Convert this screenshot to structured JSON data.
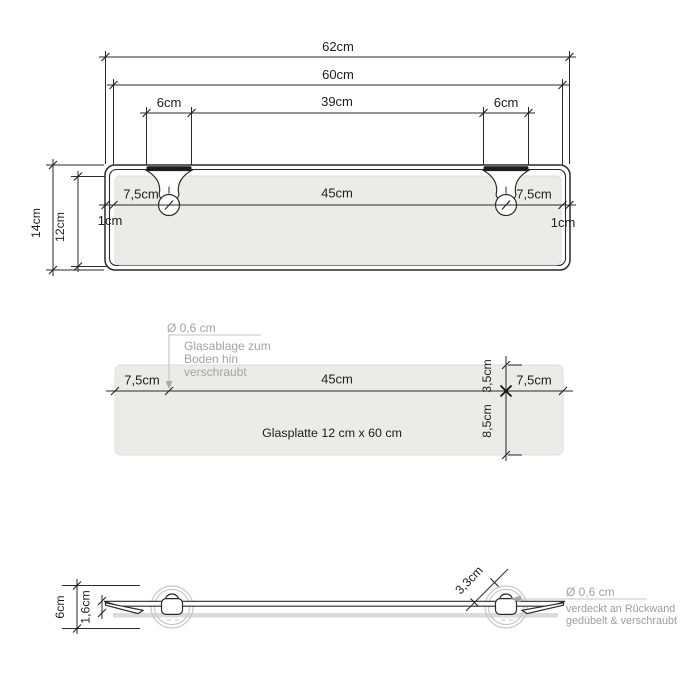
{
  "colors": {
    "line": "#2a2a2a",
    "gray_annotation": "#a3a3a3",
    "glass_fill": "#ebebe8",
    "wall_rail": "#dbdbd8",
    "mount_ring": "#c7c7c5",
    "bracket_bar": "#1c1c1c"
  },
  "top_view": {
    "total_width": "62cm",
    "glass_width": "60cm",
    "bracket_width_left": "6cm",
    "between_brackets": "39cm",
    "bracket_width_right": "6cm",
    "inset_left": "7,5cm",
    "screw_span": "45cm",
    "inset_right": "7,5cm",
    "edge_left": "1cm",
    "edge_right": "1cm",
    "total_depth": "14cm",
    "glass_depth": "12cm"
  },
  "middle_view": {
    "screw_diameter": "Ø 0,6 cm",
    "note_line1": "Glasablage zum",
    "note_line2": "Boden hin",
    "note_line3": "verschraubt",
    "inset_left": "7,5cm",
    "screw_span": "45cm",
    "inset_right": "7,5cm",
    "front_depth": "3,5cm",
    "back_depth": "8,5cm",
    "plate_label": "Glasplatte 12 cm x 60 cm"
  },
  "bottom_view": {
    "mount_height": "6cm",
    "front_thickness": "1,6cm",
    "diagonal": "3,3cm",
    "screw_diameter": "Ø 0,6 cm",
    "note_line1": "verdeckt an Rückwand",
    "note_line2": "gedübelt & verschraubt"
  }
}
